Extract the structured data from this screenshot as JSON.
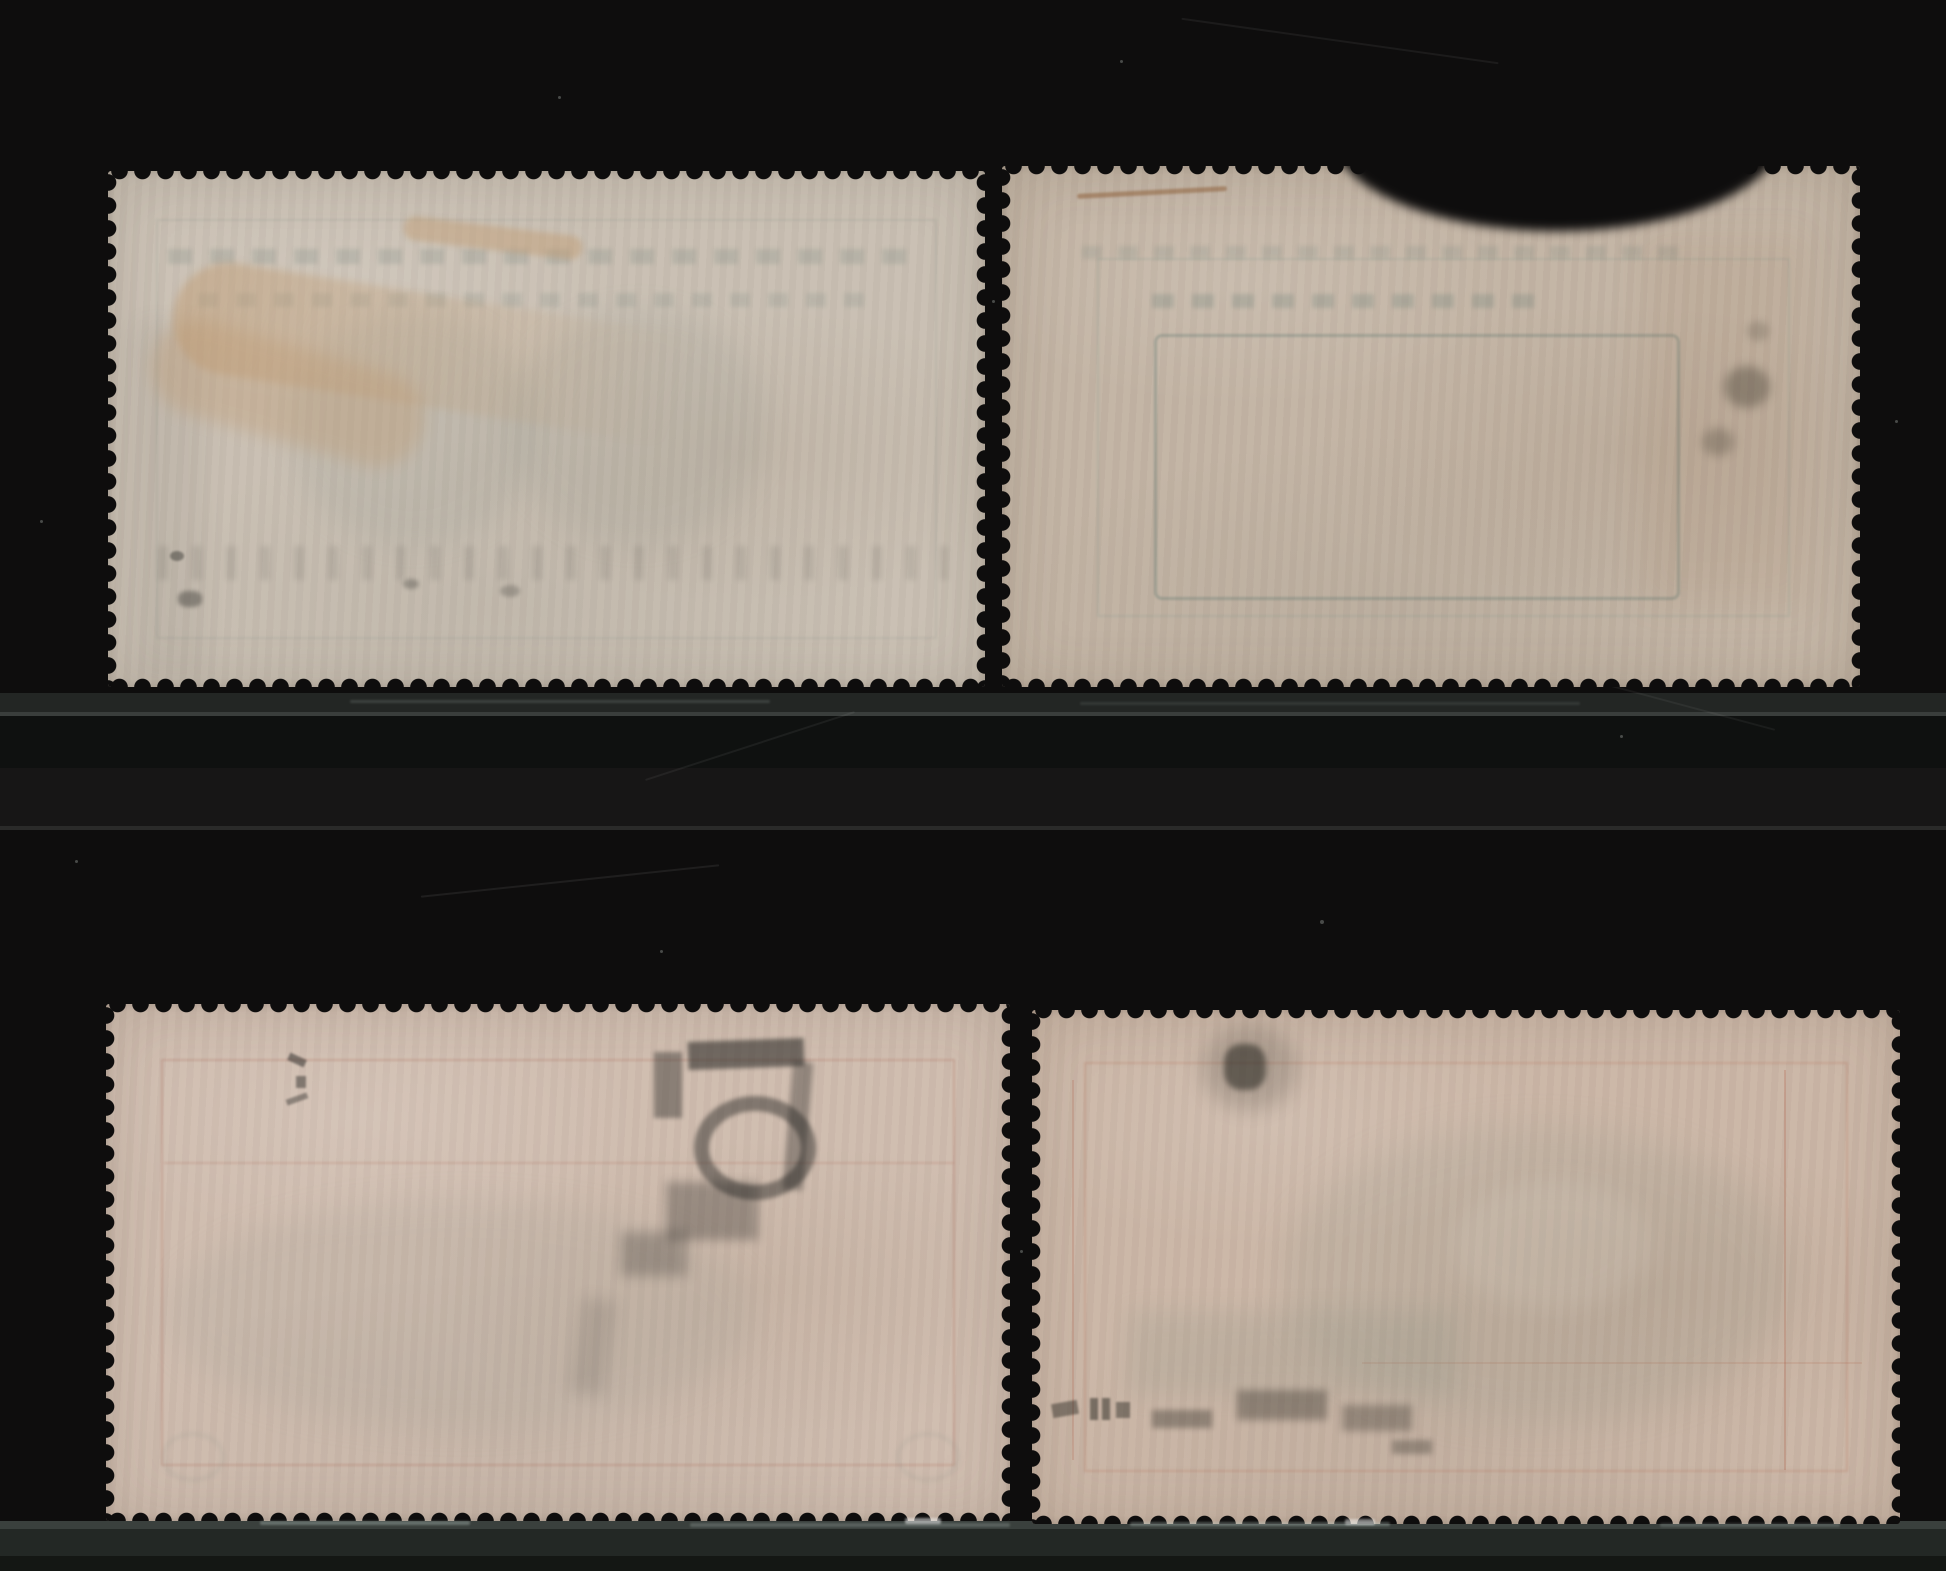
{
  "scene": {
    "background_color": "#0e0d0d",
    "dust_color": "#cfd6d2",
    "mount_strip_colors": {
      "upper_band": "#232624",
      "upper_line": "#3a3e3c",
      "upper_shadow": "#0f1110",
      "mid_band": "#171616",
      "mid_line": "#2a2a29",
      "bottom_edge": "#3a403d",
      "bottom_band": "#232825",
      "bottom_dark": "#141714"
    }
  },
  "stamps": [
    {
      "position": "top-left",
      "paper": "#c9bfb2",
      "ghost": "#74837c",
      "hinge": "#c09b72",
      "ink": "#2e2e2a",
      "frame": "#8a958d"
    },
    {
      "position": "top-right",
      "paper": "#c3b4a4",
      "ghost": "#4f6e68",
      "hinge": "#8a5a33",
      "ink": "#453f33",
      "frame": "#5f8b85"
    },
    {
      "position": "bottom-left",
      "paper": "#cfbcae",
      "ghost": "#8b9288",
      "hinge": "#c2a183",
      "ink": "#232321",
      "frame": "#a55643"
    },
    {
      "position": "bottom-right",
      "paper": "#cbb6a6",
      "ghost": "#7e8b7c",
      "hinge": "#b98f6d",
      "ink": "#26251f",
      "frame": "#b05c42"
    }
  ]
}
